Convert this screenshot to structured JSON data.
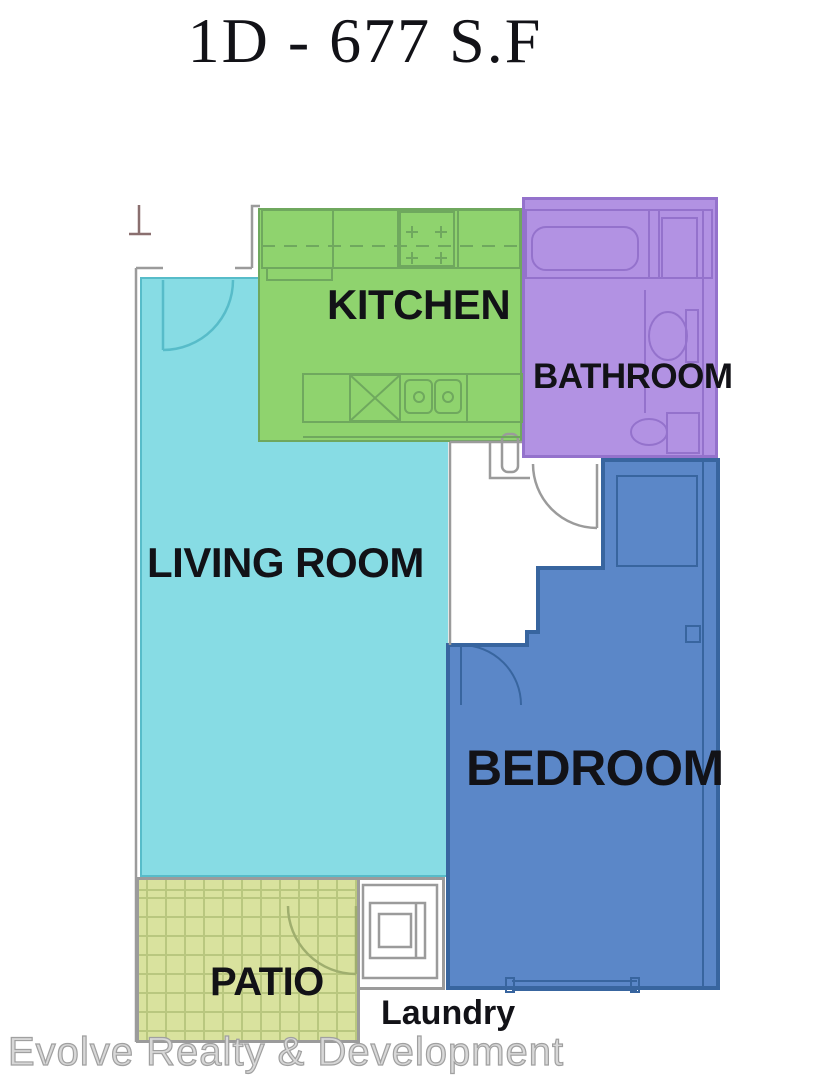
{
  "title": "1D - 677 S.F",
  "watermark": "Evolve Realty & Development",
  "rooms": {
    "kitchen": {
      "label": "KITCHEN"
    },
    "bathroom": {
      "label": "BATHROOM"
    },
    "living_room": {
      "label": "LIVING ROOM"
    },
    "bedroom": {
      "label": "BEDROOM"
    },
    "patio": {
      "label": "PATIO"
    },
    "laundry": {
      "label": "Laundry"
    }
  },
  "colors": {
    "kitchen": "#8fd36e",
    "kitchen_line": "#6fa85e",
    "bathroom": "#b292e3",
    "bathroom_line": "#9472cc",
    "living": "#87dce4",
    "living_line": "#57bcc9",
    "bedroom": "#5b87c8",
    "bedroom_line": "#38659f",
    "patio": "#d9e29e",
    "patio_grid": "#b9c77f",
    "patio_line": "#9fae6e",
    "wall": "#9b9b9b",
    "label": "#121217",
    "marker": "#8a6f6f"
  }
}
